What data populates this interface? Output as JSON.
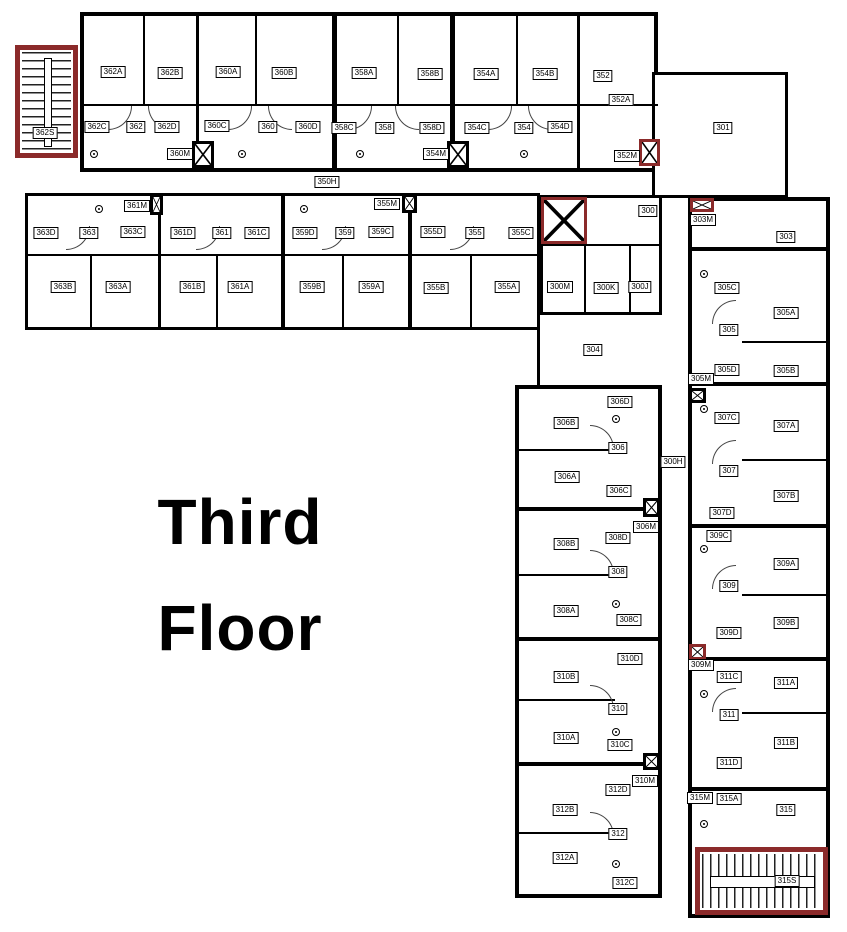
{
  "title": {
    "line1": "Third",
    "line2": "Floor"
  },
  "colors": {
    "wall": "#000000",
    "stair_accent": "#8b2a2a",
    "background": "#ffffff"
  },
  "rooms": [
    {
      "id": "362A",
      "x": 113,
      "y": 72
    },
    {
      "id": "362B",
      "x": 170,
      "y": 73
    },
    {
      "id": "360A",
      "x": 228,
      "y": 72
    },
    {
      "id": "360B",
      "x": 284,
      "y": 73
    },
    {
      "id": "358A",
      "x": 364,
      "y": 73
    },
    {
      "id": "358B",
      "x": 430,
      "y": 74
    },
    {
      "id": "354A",
      "x": 486,
      "y": 74
    },
    {
      "id": "354B",
      "x": 545,
      "y": 74
    },
    {
      "id": "352",
      "x": 603,
      "y": 76
    },
    {
      "id": "352A",
      "x": 621,
      "y": 100
    },
    {
      "id": "362C",
      "x": 97,
      "y": 127
    },
    {
      "id": "362",
      "x": 136,
      "y": 127
    },
    {
      "id": "362D",
      "x": 167,
      "y": 127
    },
    {
      "id": "360C",
      "x": 217,
      "y": 126
    },
    {
      "id": "360",
      "x": 268,
      "y": 127
    },
    {
      "id": "360D",
      "x": 308,
      "y": 127
    },
    {
      "id": "358C",
      "x": 344,
      "y": 128
    },
    {
      "id": "358",
      "x": 385,
      "y": 128
    },
    {
      "id": "358D",
      "x": 432,
      "y": 128
    },
    {
      "id": "354C",
      "x": 477,
      "y": 128
    },
    {
      "id": "354",
      "x": 524,
      "y": 128
    },
    {
      "id": "354D",
      "x": 560,
      "y": 127
    },
    {
      "id": "360M",
      "x": 180,
      "y": 154
    },
    {
      "id": "354M",
      "x": 436,
      "y": 154
    },
    {
      "id": "352M",
      "x": 627,
      "y": 156
    },
    {
      "id": "362S",
      "x": 45,
      "y": 133
    },
    {
      "id": "350H",
      "x": 327,
      "y": 182
    },
    {
      "id": "363D",
      "x": 46,
      "y": 233
    },
    {
      "id": "363",
      "x": 89,
      "y": 233
    },
    {
      "id": "363C",
      "x": 133,
      "y": 232
    },
    {
      "id": "361D",
      "x": 183,
      "y": 233
    },
    {
      "id": "361",
      "x": 222,
      "y": 233
    },
    {
      "id": "361C",
      "x": 257,
      "y": 233
    },
    {
      "id": "359D",
      "x": 305,
      "y": 233
    },
    {
      "id": "359",
      "x": 345,
      "y": 233
    },
    {
      "id": "359C",
      "x": 381,
      "y": 232
    },
    {
      "id": "355D",
      "x": 433,
      "y": 232
    },
    {
      "id": "355",
      "x": 475,
      "y": 233
    },
    {
      "id": "355C",
      "x": 521,
      "y": 233
    },
    {
      "id": "361M",
      "x": 137,
      "y": 206
    },
    {
      "id": "355M",
      "x": 387,
      "y": 204
    },
    {
      "id": "363B",
      "x": 63,
      "y": 287
    },
    {
      "id": "363A",
      "x": 118,
      "y": 287
    },
    {
      "id": "361B",
      "x": 192,
      "y": 287
    },
    {
      "id": "361A",
      "x": 240,
      "y": 287
    },
    {
      "id": "359B",
      "x": 312,
      "y": 287
    },
    {
      "id": "359A",
      "x": 371,
      "y": 287
    },
    {
      "id": "355B",
      "x": 436,
      "y": 288
    },
    {
      "id": "355A",
      "x": 507,
      "y": 287
    },
    {
      "id": "300",
      "x": 648,
      "y": 211
    },
    {
      "id": "300M",
      "x": 560,
      "y": 287
    },
    {
      "id": "300K",
      "x": 606,
      "y": 288
    },
    {
      "id": "300J",
      "x": 640,
      "y": 287
    },
    {
      "id": "304",
      "x": 593,
      "y": 350
    },
    {
      "id": "301",
      "x": 723,
      "y": 128
    },
    {
      "id": "303M",
      "x": 703,
      "y": 220
    },
    {
      "id": "303",
      "x": 786,
      "y": 237
    },
    {
      "id": "305C",
      "x": 727,
      "y": 288
    },
    {
      "id": "305A",
      "x": 786,
      "y": 313
    },
    {
      "id": "305",
      "x": 729,
      "y": 330
    },
    {
      "id": "305D",
      "x": 727,
      "y": 370
    },
    {
      "id": "305B",
      "x": 786,
      "y": 371
    },
    {
      "id": "305M",
      "x": 701,
      "y": 379
    },
    {
      "id": "307C",
      "x": 727,
      "y": 418
    },
    {
      "id": "307A",
      "x": 786,
      "y": 426
    },
    {
      "id": "307",
      "x": 729,
      "y": 471
    },
    {
      "id": "307B",
      "x": 786,
      "y": 496
    },
    {
      "id": "307D",
      "x": 722,
      "y": 513
    },
    {
      "id": "309C",
      "x": 719,
      "y": 536
    },
    {
      "id": "309A",
      "x": 786,
      "y": 564
    },
    {
      "id": "309",
      "x": 729,
      "y": 586
    },
    {
      "id": "309B",
      "x": 786,
      "y": 623
    },
    {
      "id": "309D",
      "x": 729,
      "y": 633
    },
    {
      "id": "309M",
      "x": 701,
      "y": 665
    },
    {
      "id": "311C",
      "x": 729,
      "y": 677
    },
    {
      "id": "311A",
      "x": 786,
      "y": 683
    },
    {
      "id": "311",
      "x": 729,
      "y": 715
    },
    {
      "id": "311B",
      "x": 786,
      "y": 743
    },
    {
      "id": "311D",
      "x": 729,
      "y": 763
    },
    {
      "id": "315M",
      "x": 700,
      "y": 798
    },
    {
      "id": "315A",
      "x": 729,
      "y": 799
    },
    {
      "id": "315",
      "x": 786,
      "y": 810
    },
    {
      "id": "315S",
      "x": 787,
      "y": 881
    },
    {
      "id": "306D",
      "x": 620,
      "y": 402
    },
    {
      "id": "306B",
      "x": 566,
      "y": 423
    },
    {
      "id": "306",
      "x": 618,
      "y": 448
    },
    {
      "id": "306A",
      "x": 567,
      "y": 477
    },
    {
      "id": "306C",
      "x": 619,
      "y": 491
    },
    {
      "id": "306M",
      "x": 646,
      "y": 527
    },
    {
      "id": "308D",
      "x": 618,
      "y": 538
    },
    {
      "id": "308B",
      "x": 566,
      "y": 544
    },
    {
      "id": "308",
      "x": 618,
      "y": 572
    },
    {
      "id": "308A",
      "x": 566,
      "y": 611
    },
    {
      "id": "308C",
      "x": 629,
      "y": 620
    },
    {
      "id": "310D",
      "x": 630,
      "y": 659
    },
    {
      "id": "310B",
      "x": 566,
      "y": 677
    },
    {
      "id": "310",
      "x": 618,
      "y": 709
    },
    {
      "id": "310A",
      "x": 566,
      "y": 738
    },
    {
      "id": "310C",
      "x": 620,
      "y": 745
    },
    {
      "id": "310M",
      "x": 645,
      "y": 781
    },
    {
      "id": "312D",
      "x": 618,
      "y": 790
    },
    {
      "id": "312B",
      "x": 565,
      "y": 810
    },
    {
      "id": "312",
      "x": 618,
      "y": 834
    },
    {
      "id": "312A",
      "x": 565,
      "y": 858
    },
    {
      "id": "312C",
      "x": 625,
      "y": 883
    },
    {
      "id": "300H",
      "x": 673,
      "y": 462
    }
  ],
  "shafts": [
    {
      "id": "360M",
      "x": 192,
      "y": 141,
      "w": 22,
      "h": 27,
      "red": false
    },
    {
      "id": "354M",
      "x": 447,
      "y": 141,
      "w": 22,
      "h": 27,
      "red": false
    },
    {
      "id": "352M",
      "x": 639,
      "y": 139,
      "w": 21,
      "h": 27,
      "red": true
    },
    {
      "id": "361M",
      "x": 150,
      "y": 194,
      "w": 13,
      "h": 21,
      "red": false
    },
    {
      "id": "355M",
      "x": 402,
      "y": 194,
      "w": 15,
      "h": 19,
      "red": false
    },
    {
      "id": "300",
      "x": 541,
      "y": 197,
      "w": 46,
      "h": 47,
      "red": true
    },
    {
      "id": "303M",
      "x": 690,
      "y": 198,
      "w": 24,
      "h": 14,
      "red": true
    },
    {
      "id": "305M",
      "x": 689,
      "y": 388,
      "w": 17,
      "h": 15,
      "red": false
    },
    {
      "id": "306M",
      "x": 643,
      "y": 498,
      "w": 17,
      "h": 19,
      "red": false
    },
    {
      "id": "309M",
      "x": 689,
      "y": 644,
      "w": 17,
      "h": 16,
      "red": true
    },
    {
      "id": "310M",
      "x": 643,
      "y": 753,
      "w": 17,
      "h": 17,
      "red": false
    }
  ],
  "stairs": [
    {
      "id": "362S",
      "x": 15,
      "y": 45,
      "w": 63,
      "h": 113,
      "dir": "h"
    },
    {
      "id": "315S",
      "x": 695,
      "y": 847,
      "w": 133,
      "h": 68,
      "dir": "v"
    }
  ]
}
